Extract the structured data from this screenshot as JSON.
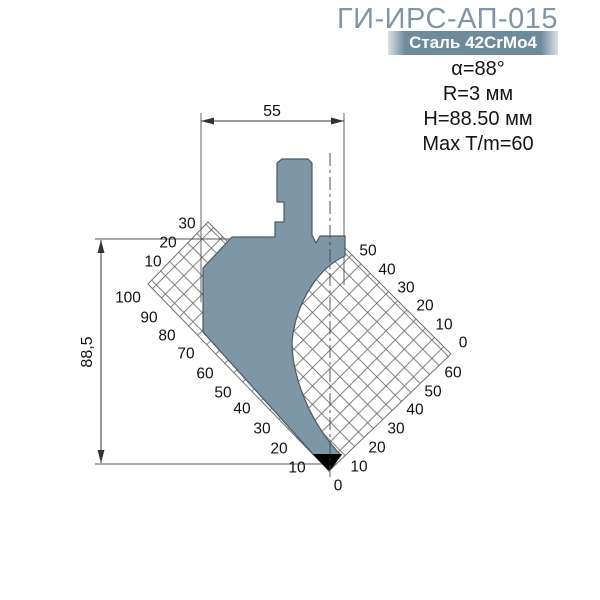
{
  "header": {
    "title": "ГИ-ИРС-АП-015",
    "material_badge": "Сталь 42CrMo4",
    "specs": [
      "α=88°",
      "R=3 мм",
      "H=88.50 мм",
      "Max T/m=60"
    ]
  },
  "drawing": {
    "width_dim": "55",
    "height_dim": "88,5",
    "scale_labels": [
      {
        "text": "30",
        "x": 187,
        "y": 223
      },
      {
        "text": "20",
        "x": 168,
        "y": 242
      },
      {
        "text": "10",
        "x": 153,
        "y": 261
      },
      {
        "text": "100",
        "x": 128,
        "y": 297
      },
      {
        "text": "90",
        "x": 149,
        "y": 317
      },
      {
        "text": "80",
        "x": 167,
        "y": 335
      },
      {
        "text": "70",
        "x": 186,
        "y": 353
      },
      {
        "text": "60",
        "x": 205,
        "y": 373
      },
      {
        "text": "50",
        "x": 223,
        "y": 392
      },
      {
        "text": "40",
        "x": 242,
        "y": 408
      },
      {
        "text": "30",
        "x": 262,
        "y": 428
      },
      {
        "text": "20",
        "x": 279,
        "y": 448
      },
      {
        "text": "10",
        "x": 297,
        "y": 467
      },
      {
        "text": "0",
        "x": 338,
        "y": 485
      },
      {
        "text": "50",
        "x": 368,
        "y": 250
      },
      {
        "text": "40",
        "x": 387,
        "y": 269
      },
      {
        "text": "30",
        "x": 406,
        "y": 287
      },
      {
        "text": "20",
        "x": 425,
        "y": 305
      },
      {
        "text": "10",
        "x": 444,
        "y": 324
      },
      {
        "text": "0",
        "x": 463,
        "y": 342
      },
      {
        "text": "60",
        "x": 453,
        "y": 372
      },
      {
        "text": "50",
        "x": 433,
        "y": 391
      },
      {
        "text": "40",
        "x": 415,
        "y": 409
      },
      {
        "text": "30",
        "x": 396,
        "y": 428
      },
      {
        "text": "20",
        "x": 377,
        "y": 447
      },
      {
        "text": "10",
        "x": 359,
        "y": 466
      }
    ]
  },
  "colors": {
    "accent": "#7E96AA",
    "badge_bg": "#6E8B9E",
    "punch_fill": "#7D97A6",
    "punch_stroke": "#4A5A64",
    "hatch": "#6f6f6f",
    "dim": "#333333",
    "label": "#111111",
    "tip": "#000000"
  }
}
